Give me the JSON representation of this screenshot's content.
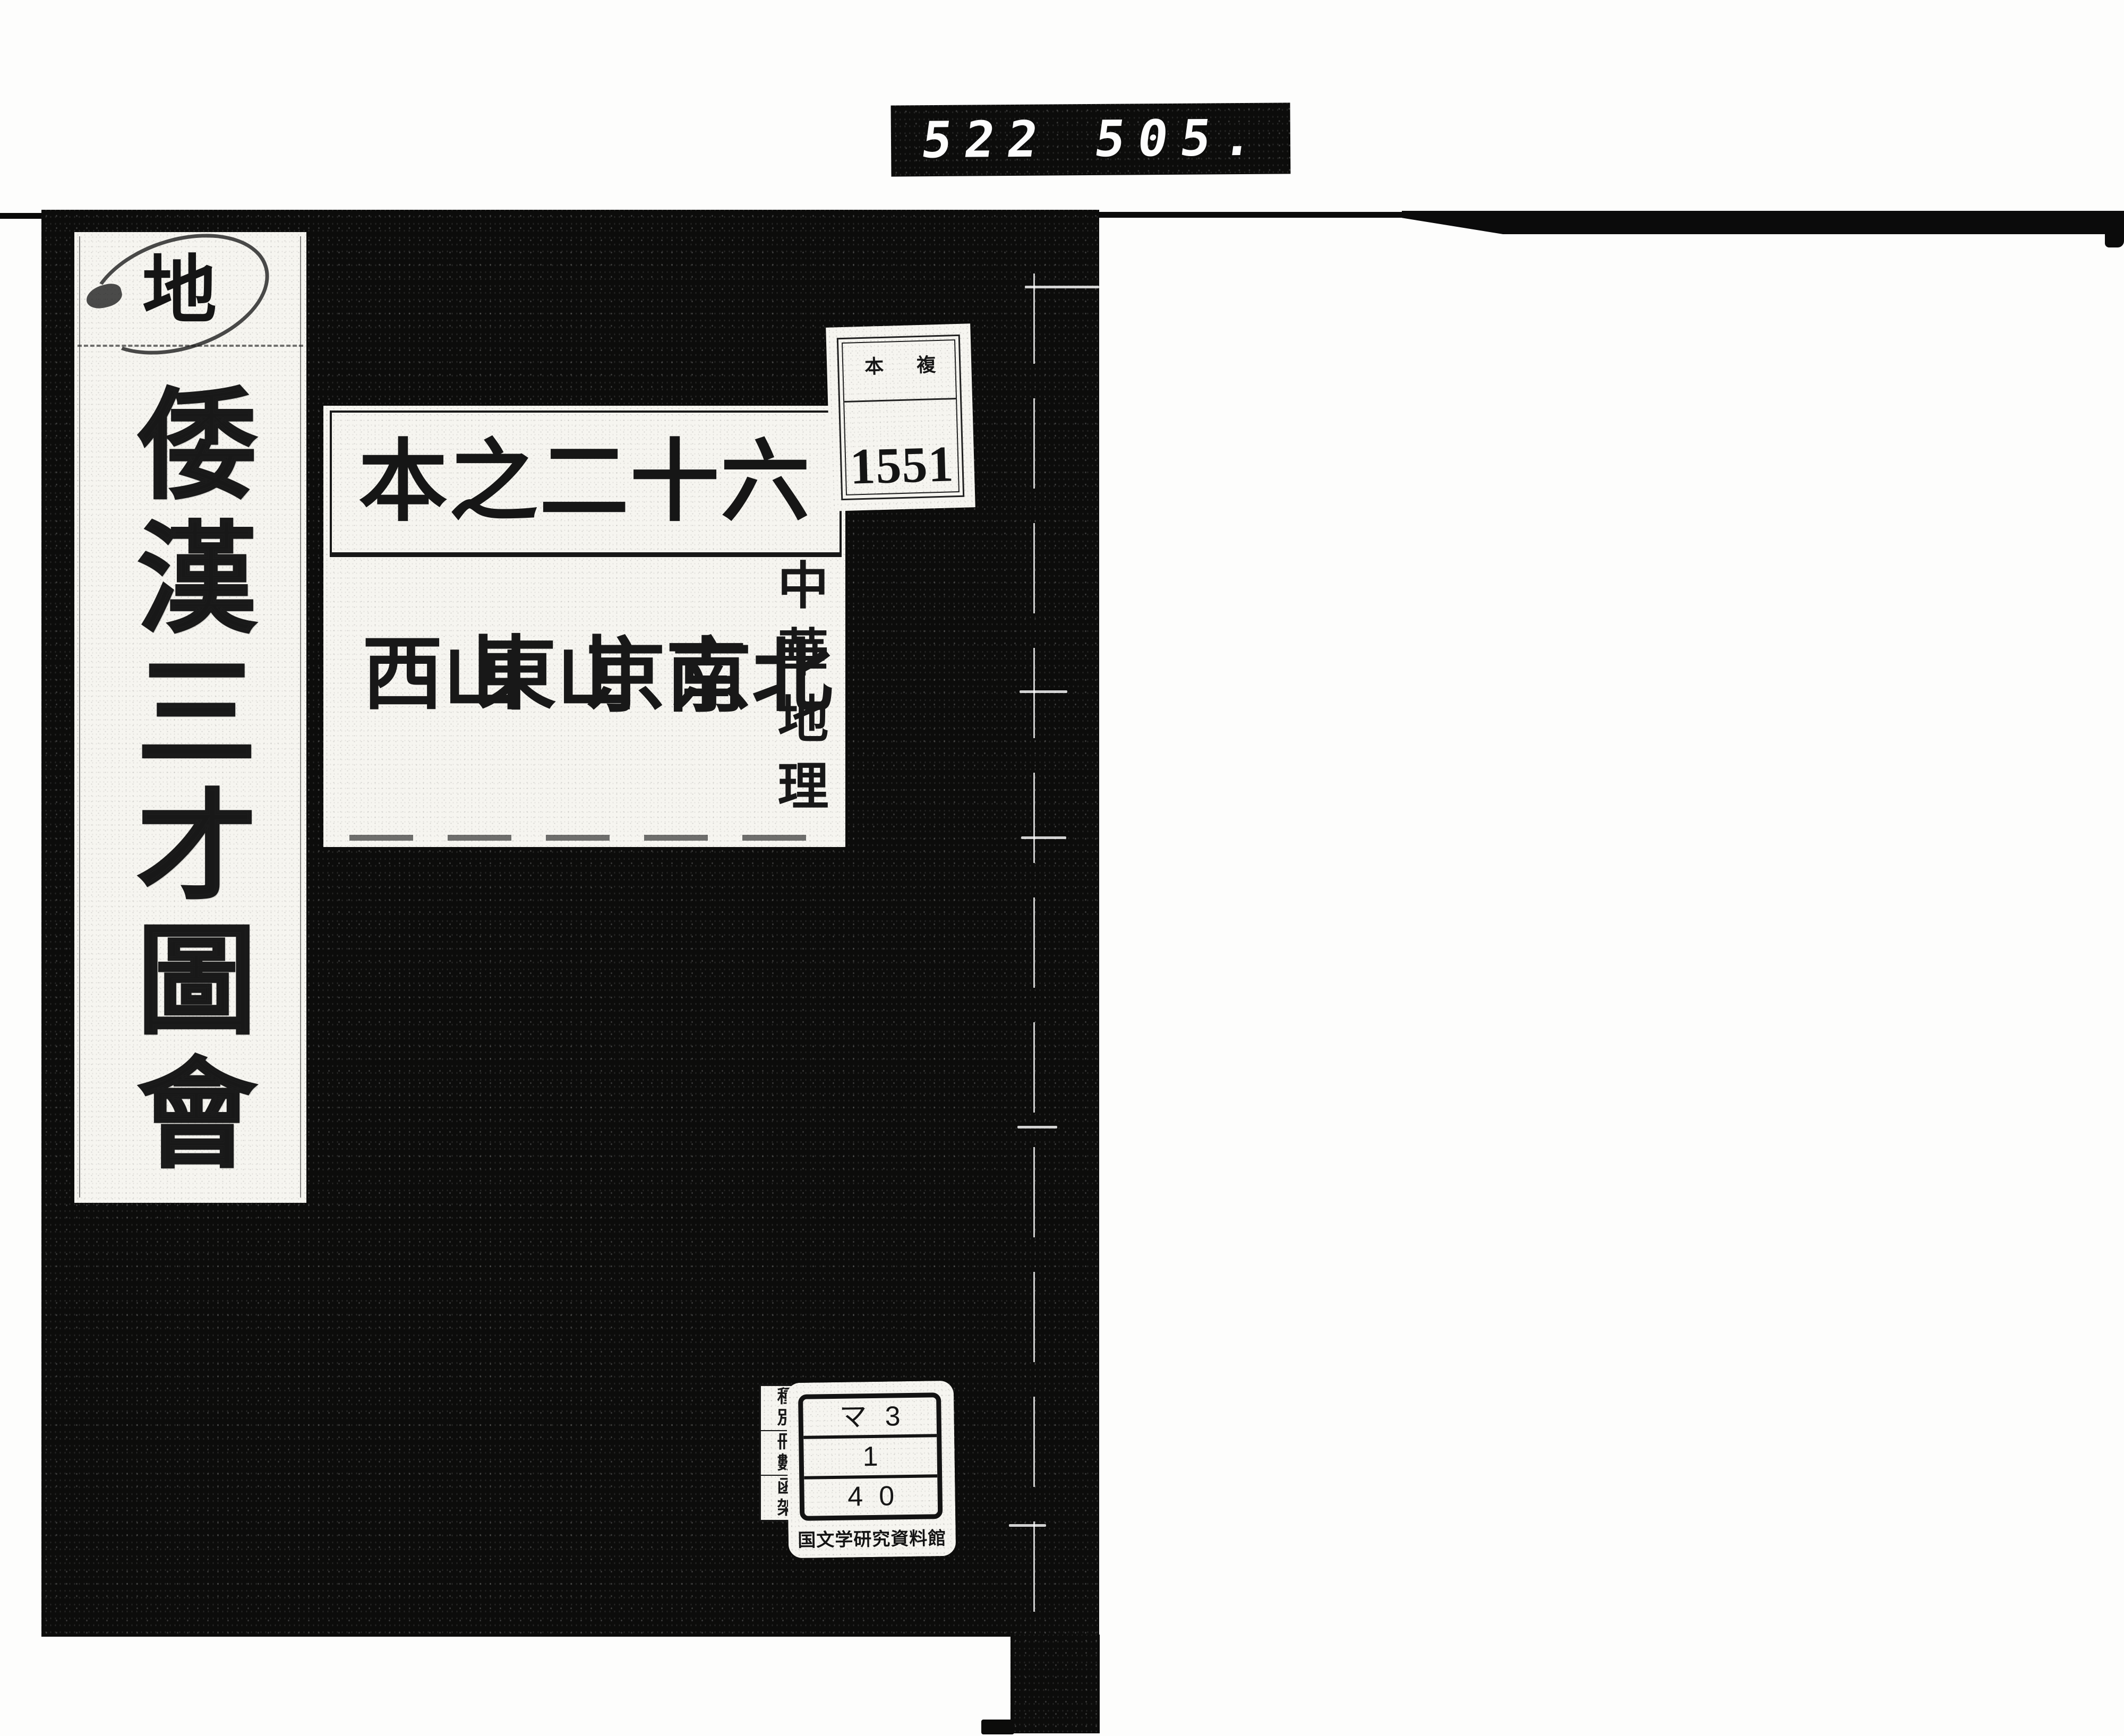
{
  "colors": {
    "cover_black": "#0c0c0b",
    "paper_white": "#f6f5f0",
    "ink_black": "#1c1c1c",
    "digit_white": "#fcfcfc"
  },
  "ocr_digit_strip": {
    "left_group": "522",
    "right_group": "505."
  },
  "spine_slip": {
    "seal_char": "地",
    "title": "倭漢三才圖會",
    "title_chars": [
      "倭",
      "漢",
      "三",
      "才",
      "圖",
      "會"
    ]
  },
  "title_label": {
    "volume_header_chars": [
      "本",
      "之",
      "二",
      "十",
      "六"
    ],
    "volume_header_reading": "六十二之本",
    "series_column": "中華地理",
    "region_columns": [
      "北京",
      "南京",
      "山東",
      "山西"
    ]
  },
  "accession_label": {
    "header_left": "本",
    "header_right": "複",
    "number": "1551"
  },
  "call_number_label": {
    "side_groups": [
      "種別",
      "冊數",
      "函架"
    ],
    "rows": [
      "マ3",
      "1",
      "40"
    ],
    "institution": "国文学研究資料館"
  }
}
